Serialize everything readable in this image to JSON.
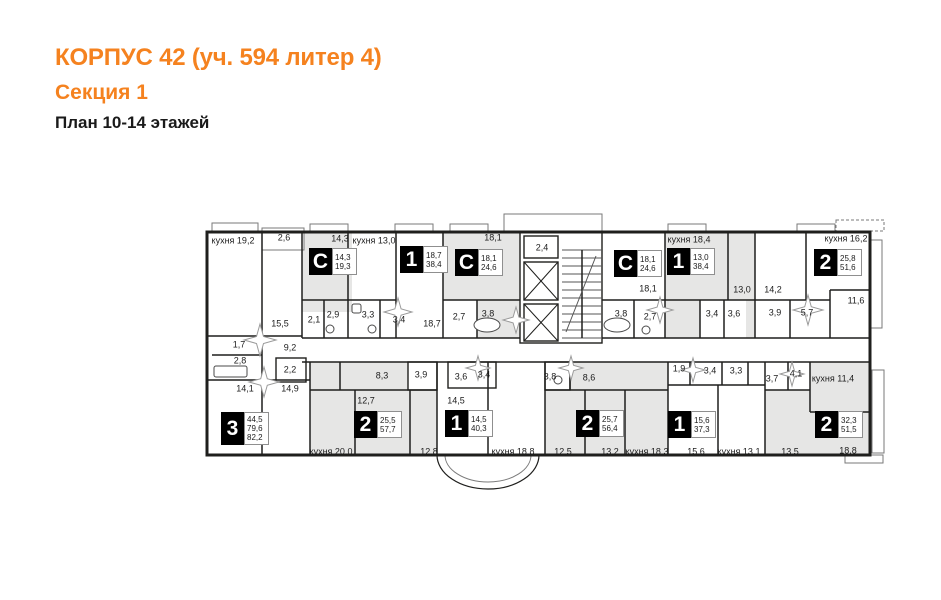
{
  "header": {
    "title": "КОРПУС 42 (уч. 594 литер 4)",
    "section": "Секция 1",
    "plan_label": "План 10-14 этажей",
    "accent_color": "#f5821f"
  },
  "plan": {
    "wall_color": "#1f1f1d",
    "room_fill": "#e6e6e5",
    "balcony_stroke": "#7a7a7a",
    "labels": [
      {
        "text": "кухня 19,2",
        "x": 233,
        "y": 241
      },
      {
        "text": "2,6",
        "x": 284,
        "y": 238
      },
      {
        "text": "14,3",
        "x": 340,
        "y": 239
      },
      {
        "text": "кухня 13,0",
        "x": 374,
        "y": 241
      },
      {
        "text": "18,1",
        "x": 493,
        "y": 238
      },
      {
        "text": "2,4",
        "x": 542,
        "y": 248
      },
      {
        "text": "кухня 18,4",
        "x": 689,
        "y": 240
      },
      {
        "text": "кухня 16,2",
        "x": 846,
        "y": 239
      },
      {
        "text": "15,5",
        "x": 280,
        "y": 324
      },
      {
        "text": "2,1",
        "x": 314,
        "y": 320
      },
      {
        "text": "2,9",
        "x": 333,
        "y": 315
      },
      {
        "text": "3,3",
        "x": 368,
        "y": 315
      },
      {
        "text": "3,4",
        "x": 399,
        "y": 320
      },
      {
        "text": "18,7",
        "x": 432,
        "y": 324
      },
      {
        "text": "2,7",
        "x": 459,
        "y": 317
      },
      {
        "text": "3,8",
        "x": 488,
        "y": 314
      },
      {
        "text": "18,1",
        "x": 648,
        "y": 289
      },
      {
        "text": "3,8",
        "x": 621,
        "y": 314
      },
      {
        "text": "2,7",
        "x": 650,
        "y": 317
      },
      {
        "text": "13,0",
        "x": 742,
        "y": 290
      },
      {
        "text": "14,2",
        "x": 773,
        "y": 290
      },
      {
        "text": "3,4",
        "x": 712,
        "y": 314
      },
      {
        "text": "3,6",
        "x": 734,
        "y": 314
      },
      {
        "text": "3,9",
        "x": 775,
        "y": 313
      },
      {
        "text": "5,7",
        "x": 807,
        "y": 313
      },
      {
        "text": "11,6",
        "x": 856,
        "y": 301
      },
      {
        "text": "1,7",
        "x": 239,
        "y": 345
      },
      {
        "text": "9,2",
        "x": 290,
        "y": 348
      },
      {
        "text": "2,8",
        "x": 240,
        "y": 361
      },
      {
        "text": "2,2",
        "x": 290,
        "y": 370
      },
      {
        "text": "14,1",
        "x": 245,
        "y": 389
      },
      {
        "text": "14,9",
        "x": 290,
        "y": 389
      },
      {
        "text": "8,3",
        "x": 382,
        "y": 376
      },
      {
        "text": "3,9",
        "x": 421,
        "y": 375
      },
      {
        "text": "3,6",
        "x": 461,
        "y": 377
      },
      {
        "text": "3,4",
        "x": 484,
        "y": 375
      },
      {
        "text": "3,8",
        "x": 550,
        "y": 377
      },
      {
        "text": "8,6",
        "x": 589,
        "y": 378
      },
      {
        "text": "1,9",
        "x": 679,
        "y": 369
      },
      {
        "text": "3,4",
        "x": 710,
        "y": 371
      },
      {
        "text": "3,3",
        "x": 736,
        "y": 371
      },
      {
        "text": "3,7",
        "x": 772,
        "y": 379
      },
      {
        "text": "4,1",
        "x": 796,
        "y": 374
      },
      {
        "text": "кухня 11,4",
        "x": 833,
        "y": 379
      },
      {
        "text": "12,7",
        "x": 366,
        "y": 401
      },
      {
        "text": "14,5",
        "x": 456,
        "y": 401
      },
      {
        "text": "кухня 20,0",
        "x": 331,
        "y": 452
      },
      {
        "text": "12,8",
        "x": 429,
        "y": 452
      },
      {
        "text": "кухня 18,8",
        "x": 513,
        "y": 452
      },
      {
        "text": "12,5",
        "x": 563,
        "y": 452
      },
      {
        "text": "13,2",
        "x": 610,
        "y": 452
      },
      {
        "text": "кухня 18,3",
        "x": 647,
        "y": 452
      },
      {
        "text": "15,6",
        "x": 696,
        "y": 452
      },
      {
        "text": "кухня 13,1",
        "x": 739,
        "y": 452
      },
      {
        "text": "13,5",
        "x": 790,
        "y": 452
      },
      {
        "text": "18,8",
        "x": 848,
        "y": 451
      }
    ],
    "apartments": [
      {
        "type": "С",
        "areas": [
          "14,3",
          "19,3"
        ],
        "x": 309,
        "y": 248
      },
      {
        "type": "1",
        "areas": [
          "18,7",
          "38,4"
        ],
        "x": 400,
        "y": 246
      },
      {
        "type": "С",
        "areas": [
          "18,1",
          "24,6"
        ],
        "x": 455,
        "y": 249
      },
      {
        "type": "С",
        "areas": [
          "18,1",
          "24,6"
        ],
        "x": 614,
        "y": 250
      },
      {
        "type": "1",
        "areas": [
          "13,0",
          "38,4"
        ],
        "x": 667,
        "y": 248
      },
      {
        "type": "2",
        "areas": [
          "25,8",
          "51,6"
        ],
        "x": 814,
        "y": 249
      },
      {
        "type": "3",
        "areas": [
          "44,5",
          "79,6",
          "82,2"
        ],
        "x": 221,
        "y": 412
      },
      {
        "type": "2",
        "areas": [
          "25,5",
          "57,7"
        ],
        "x": 354,
        "y": 411
      },
      {
        "type": "1",
        "areas": [
          "14,5",
          "40,3"
        ],
        "x": 445,
        "y": 410
      },
      {
        "type": "2",
        "areas": [
          "25,7",
          "56,4"
        ],
        "x": 576,
        "y": 410
      },
      {
        "type": "1",
        "areas": [
          "15,6",
          "37,3"
        ],
        "x": 668,
        "y": 411
      },
      {
        "type": "2",
        "areas": [
          "32,3",
          "51,5"
        ],
        "x": 815,
        "y": 411
      }
    ],
    "geometry": {
      "outer": [
        207,
        232,
        663,
        223
      ],
      "fills": [
        [
          302,
          232,
          50,
          80
        ],
        [
          443,
          232,
          77,
          106
        ],
        [
          665,
          232,
          90,
          106
        ],
        [
          310,
          362,
          127,
          93
        ],
        [
          545,
          362,
          123,
          93
        ],
        [
          765,
          362,
          105,
          93
        ]
      ],
      "white_fills": [
        [
          443,
          300,
          34,
          38
        ],
        [
          700,
          300,
          46,
          38
        ],
        [
          408,
          362,
          29,
          28
        ],
        [
          545,
          362,
          25,
          28
        ],
        [
          765,
          362,
          45,
          28
        ]
      ],
      "balconies": [
        [
          212,
          223,
          46,
          9,
          0
        ],
        [
          262,
          228,
          42,
          22,
          0
        ],
        [
          310,
          224,
          38,
          7,
          0
        ],
        [
          395,
          224,
          38,
          7,
          0
        ],
        [
          450,
          224,
          38,
          7,
          0
        ],
        [
          668,
          224,
          38,
          7,
          0
        ],
        [
          797,
          224,
          38,
          7,
          0
        ],
        [
          836,
          220,
          48,
          11,
          1
        ],
        [
          504,
          214,
          98,
          18,
          0
        ],
        [
          870,
          240,
          12,
          88,
          0
        ],
        [
          872,
          370,
          12,
          83,
          0
        ],
        [
          845,
          455,
          38,
          8,
          0
        ]
      ],
      "curve": {
        "outer": "M437 455 A51 34 0 0 0 539 455",
        "inner": "M445 455 A43 27 0 0 0 531 455"
      },
      "walls_v": [
        [
          302,
          232,
          338
        ],
        [
          348,
          232,
          338
        ],
        [
          396,
          232,
          338
        ],
        [
          443,
          232,
          338
        ],
        [
          665,
          232,
          338
        ],
        [
          755,
          232,
          338
        ],
        [
          728,
          232,
          300
        ],
        [
          806,
          232,
          300
        ],
        [
          830,
          290,
          338
        ],
        [
          324,
          300,
          338
        ],
        [
          380,
          300,
          338
        ],
        [
          477,
          300,
          338
        ],
        [
          634,
          300,
          338
        ],
        [
          700,
          300,
          338
        ],
        [
          724,
          300,
          338
        ],
        [
          790,
          300,
          338
        ],
        [
          262,
          232,
          455
        ],
        [
          310,
          362,
          455
        ],
        [
          437,
          362,
          455
        ],
        [
          545,
          362,
          455
        ],
        [
          668,
          362,
          455
        ],
        [
          765,
          362,
          455
        ],
        [
          340,
          362,
          390
        ],
        [
          355,
          390,
          455
        ],
        [
          410,
          390,
          455
        ],
        [
          488,
          362,
          455
        ],
        [
          570,
          362,
          390
        ],
        [
          585,
          390,
          455
        ],
        [
          625,
          390,
          455
        ],
        [
          690,
          362,
          385
        ],
        [
          722,
          362,
          385
        ],
        [
          748,
          362,
          385
        ],
        [
          718,
          385,
          455
        ],
        [
          788,
          362,
          390
        ],
        [
          810,
          362,
          412
        ]
      ],
      "walls_h": [
        [
          338,
          302,
          520
        ],
        [
          338,
          602,
          870
        ],
        [
          362,
          302,
          870
        ],
        [
          300,
          302,
          396
        ],
        [
          300,
          443,
          520
        ],
        [
          300,
          602,
          830
        ],
        [
          290,
          830,
          870
        ],
        [
          336,
          207,
          302
        ],
        [
          380,
          207,
          310
        ],
        [
          355,
          212,
          262
        ],
        [
          390,
          310,
          437
        ],
        [
          390,
          545,
          668
        ],
        [
          390,
          765,
          810
        ],
        [
          385,
          668,
          765
        ],
        [
          412,
          810,
          870
        ]
      ],
      "wall_rects": [
        [
          276,
          358,
          30,
          24
        ],
        [
          448,
          362,
          48,
          26
        ],
        [
          408,
          362,
          29,
          28
        ],
        [
          545,
          362,
          25,
          28
        ],
        [
          520,
          232,
          82,
          111
        ],
        [
          524,
          236,
          34,
          22
        ],
        [
          524,
          262,
          34,
          38
        ],
        [
          524,
          304,
          34,
          37
        ]
      ],
      "shaft_x": [
        [
          524,
          262,
          34,
          38
        ],
        [
          524,
          304,
          34,
          37
        ]
      ],
      "stairs": {
        "x": 562,
        "y": 250,
        "w": 40,
        "h": 88,
        "step": 8
      },
      "bursts": [
        [
          260,
          340,
          16
        ],
        [
          264,
          382,
          15
        ],
        [
          398,
          312,
          14
        ],
        [
          516,
          320,
          13
        ],
        [
          660,
          310,
          13
        ],
        [
          808,
          310,
          15
        ],
        [
          478,
          368,
          12
        ],
        [
          571,
          368,
          12
        ],
        [
          693,
          370,
          12
        ],
        [
          792,
          374,
          12
        ]
      ],
      "fixtures": [
        {
          "s": "ellipse",
          "x": 487,
          "y": 325,
          "rx": 13,
          "ry": 7
        },
        {
          "s": "ellipse",
          "x": 617,
          "y": 325,
          "rx": 13,
          "ry": 7
        },
        {
          "s": "rect",
          "x": 214,
          "y": 366,
          "w": 33,
          "h": 11
        },
        {
          "s": "rect",
          "x": 352,
          "y": 304,
          "w": 9,
          "h": 9
        },
        {
          "s": "circle",
          "x": 372,
          "y": 329,
          "r": 4
        },
        {
          "s": "circle",
          "x": 646,
          "y": 330,
          "r": 4
        },
        {
          "s": "circle",
          "x": 330,
          "y": 329,
          "r": 4
        },
        {
          "s": "circle",
          "x": 558,
          "y": 380,
          "r": 4
        }
      ]
    }
  }
}
